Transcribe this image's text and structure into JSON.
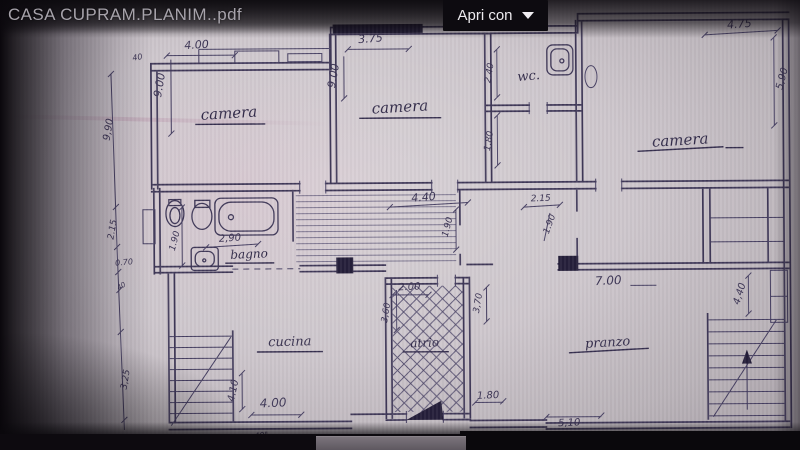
{
  "viewer": {
    "filename": "CASA CUPRAM.PLANIM..pdf",
    "open_with": {
      "label": "Apri con"
    }
  },
  "colors": {
    "ink": "#3f3858",
    "paper": "#cdc6cc",
    "topbar": "#0d0b10",
    "button_bg": "#0d0b10",
    "button_text": "#edebef",
    "title_text": "#a7a3ab"
  },
  "plan": {
    "room_labels": [
      {
        "text": "camera",
        "x": 230,
        "y": 117,
        "fs": 15,
        "r": -3
      },
      {
        "text": "camera",
        "x": 401,
        "y": 112,
        "fs": 15,
        "r": -3
      },
      {
        "text": "wc.",
        "x": 530,
        "y": 81,
        "fs": 13,
        "r": -5
      },
      {
        "text": "camera",
        "x": 681,
        "y": 147,
        "fs": 15,
        "r": -3
      },
      {
        "text": "bagno",
        "x": 249,
        "y": 257,
        "fs": 12,
        "r": -2
      },
      {
        "text": "atrio",
        "x": 424,
        "y": 347,
        "fs": 12,
        "r": -2
      },
      {
        "text": "cucina",
        "x": 289,
        "y": 345,
        "fs": 13,
        "r": -1
      },
      {
        "text": "pranzo",
        "x": 607,
        "y": 348,
        "fs": 13,
        "r": -3
      }
    ],
    "dims": [
      {
        "text": "4.00",
        "x": 198,
        "y": 47,
        "fs": 11,
        "r": -3
      },
      {
        "text": "9.00",
        "x": 164,
        "y": 84,
        "fs": 11,
        "r": -80
      },
      {
        "text": "40",
        "x": 139,
        "y": 58,
        "fs": 8,
        "r": -10
      },
      {
        "text": "3.75",
        "x": 372,
        "y": 42,
        "fs": 11,
        "r": -4
      },
      {
        "text": "9.00",
        "x": 338,
        "y": 76,
        "fs": 11,
        "r": -80
      },
      {
        "text": "4.75",
        "x": 741,
        "y": 30,
        "fs": 11,
        "r": -4
      },
      {
        "text": "5,90",
        "x": 786,
        "y": 82,
        "fs": 10,
        "r": -75
      },
      {
        "text": "2.40",
        "x": 493,
        "y": 74,
        "fs": 9,
        "r": -80
      },
      {
        "text": "1.80",
        "x": 492,
        "y": 142,
        "fs": 9,
        "r": -80
      },
      {
        "text": "1.90",
        "x": 177,
        "y": 240,
        "fs": 9,
        "r": -75
      },
      {
        "text": "2,90",
        "x": 230,
        "y": 240,
        "fs": 10,
        "r": -3
      },
      {
        "text": "4.40",
        "x": 424,
        "y": 201,
        "fs": 11,
        "r": -4
      },
      {
        "text": "1.90",
        "x": 450,
        "y": 228,
        "fs": 9,
        "r": -75
      },
      {
        "text": "2.15",
        "x": 541,
        "y": 202,
        "fs": 9,
        "r": -2
      },
      {
        "text": "1.90",
        "x": 552,
        "y": 226,
        "fs": 9,
        "r": -70
      },
      {
        "text": "2.00",
        "x": 409,
        "y": 290,
        "fs": 10,
        "r": -2
      },
      {
        "text": "3,60",
        "x": 388,
        "y": 313,
        "fs": 9,
        "r": -80
      },
      {
        "text": "3,70",
        "x": 480,
        "y": 304,
        "fs": 9,
        "r": -80
      },
      {
        "text": "1.80",
        "x": 487,
        "y": 399,
        "fs": 10,
        "r": -2
      },
      {
        "text": "7.00",
        "x": 608,
        "y": 286,
        "fs": 12,
        "r": -2
      },
      {
        "text": "4,40",
        "x": 742,
        "y": 297,
        "fs": 10,
        "r": -72
      },
      {
        "text": "4.10",
        "x": 235,
        "y": 390,
        "fs": 10,
        "r": -78
      },
      {
        "text": "4.00",
        "x": 272,
        "y": 406,
        "fs": 12,
        "r": -2
      },
      {
        "text": "40\"",
        "x": 260,
        "y": 437,
        "fs": 8,
        "r": -5
      },
      {
        "text": "5,10",
        "x": 568,
        "y": 427,
        "fs": 10,
        "r": -2
      },
      {
        "text": "9,90",
        "x": 112,
        "y": 128,
        "fs": 10,
        "r": -80
      },
      {
        "text": "2.15",
        "x": 115,
        "y": 228,
        "fs": 9,
        "r": -80
      },
      {
        "text": "0.70",
        "x": 124,
        "y": 263,
        "fs": 8,
        "r": -5
      },
      {
        "text": "40",
        "x": 122,
        "y": 286,
        "fs": 7,
        "r": -30
      },
      {
        "text": "3,25",
        "x": 127,
        "y": 378,
        "fs": 9,
        "r": -80
      }
    ]
  }
}
